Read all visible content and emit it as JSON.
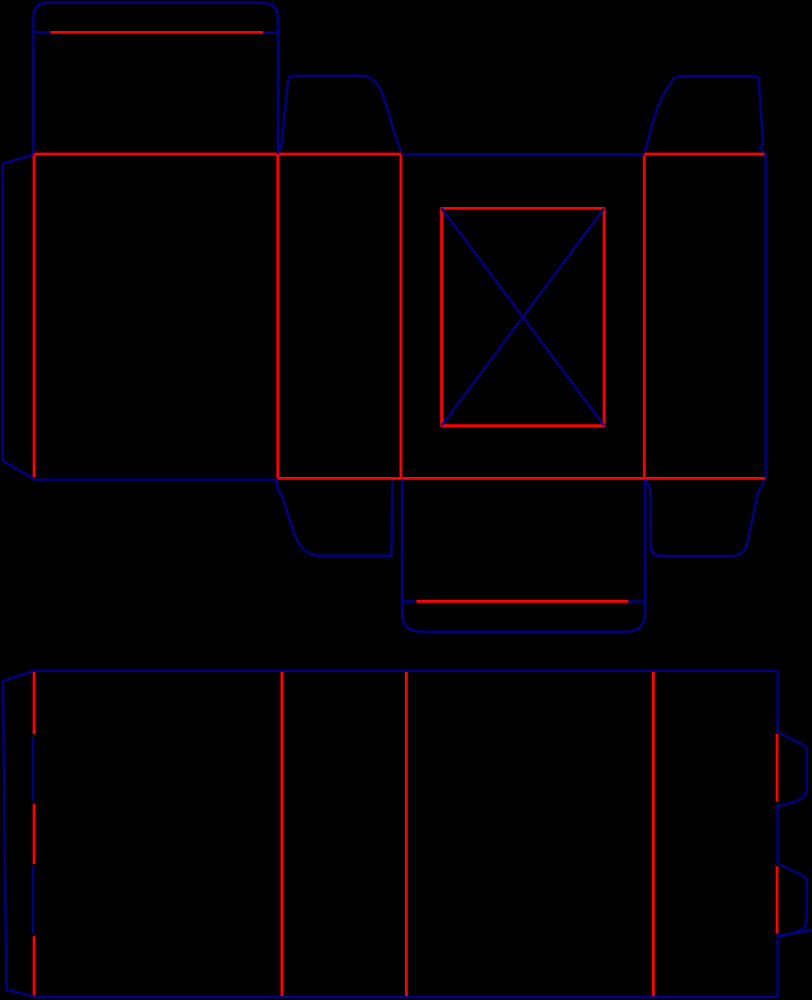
{
  "canvas": {
    "width": 812,
    "height": 1000,
    "background": "#000000"
  },
  "styles": {
    "cut": {
      "color": "#00008b",
      "width": 2.3
    },
    "crease": {
      "color": "#ff0000",
      "width": 2.8
    }
  },
  "diagram": {
    "type": "packaging-dieline",
    "pieces": [
      {
        "name": "upper-carton-blank",
        "creases": [
          {
            "name": "lid-lip-crease",
            "d": "M 50.2 32.4 L 263.2 32.4"
          },
          {
            "name": "band-top-crease-left",
            "d": "M 33.4 154 L 400.9 154"
          },
          {
            "name": "band-top-crease-right",
            "d": "M 644.3 154 L 765.6 154"
          },
          {
            "name": "band-bottom-crease",
            "d": "M 277.8 478.4 L 765.6 478.4"
          },
          {
            "name": "glue-flap-crease",
            "d": "M 34 154 L 34 477.6"
          },
          {
            "name": "panel1-panel2-crease",
            "d": "M 277.8 154 L 277.8 478.4"
          },
          {
            "name": "panel2-panel3-crease",
            "d": "M 400.9 154 L 400.9 478.4"
          },
          {
            "name": "panel3-panel4-crease",
            "d": "M 644.3 154 L 644.3 478.4"
          },
          {
            "name": "tuck-lip-crease",
            "d": "M 416.3 601.4 L 628.4 601.4"
          },
          {
            "name": "window-frame",
            "d": "M 441.6 208.4 L 604.1 208.4 L 604.1 425.6 L 441.6 425.6 Z"
          }
        ],
        "cuts": [
          {
            "name": "lid-flap-outline",
            "d": "M 33.4 154 L 33.4 18 Q 33.4 2.6 49 2.6 L 262 2.6 Q 277.8 2.6 277.8 18 L 277.8 154"
          },
          {
            "name": "lid-lip-cut-tick-left",
            "d": "M 33.4 32.4 L 50.2 32.4"
          },
          {
            "name": "lid-lip-cut-tick-right",
            "d": "M 263.2 32.4 L 277.8 32.4"
          },
          {
            "name": "glue-flap-outline",
            "d": "M 33.4 154.6 L 2.9 163.6 L 2.4 460.6 L 33.4 478.4"
          },
          {
            "name": "panel1-bottom-cut",
            "d": "M 33.4 479.6 L 277.2 479.6"
          },
          {
            "name": "top-dust-flap-left",
            "d": "M 278.4 151.6 L 281.4 146 L 288.3 79 Q 288.9 75.6 293.1 75.6 L 362 75.6 C 374 76.6 380.2 86.2 384.7 100.2 L 391.7 124 Q 395.2 136.2 397.5 142.2 L 399.2 147.4 L 400.9 152"
          },
          {
            "name": "top-dust-flap-right",
            "d": "M 644.4 152 L 646.4 146.6 L 649.6 134.6 C 654.1 114.2 661.2 96.2 669.7 84.7 Q 673.7 75.9 681.7 75.9 L 753.6 75.9 Q 758.4 75.9 758.7 80.6 L 763 143.6 L 759.7 148.7 L 765.5 153"
          },
          {
            "name": "panel3-top-cut",
            "d": "M 400.9 154.3 L 644.3 154.3"
          },
          {
            "name": "band-right-edge-cut",
            "d": "M 765.6 153.2 L 765.6 477.4"
          },
          {
            "name": "bottom-dust-flap-left",
            "d": "M 277 479.8 L 277.8 490.6 L 282 495.6 L 291.6 526.2 C 296.1 540.7 301.1 549.2 309.1 553.2 Q 313.6 555.7 321.1 555.7 L 391.4 555.7 L 392.3 480.6"
          },
          {
            "name": "bottom-dust-flap-right",
            "d": "M 646 480.2 L 647.8 484.2 L 650.1 487.7 L 650.9 546.2 Q 651.1 555.9 660.6 555.9 L 731.1 555.9 Q 743.6 555.9 747.1 544.2 L 756.6 498.7 L 758.2 491.2 L 761.7 486.4 L 764.2 480.2"
          },
          {
            "name": "tuck-flap-outline",
            "d": "M 401.9 479.2 L 401.9 612.6 Q 401.9 631.7 421.6 631.7 L 625.9 631.7 Q 645.2 631.7 645.2 612.6 L 645.2 479.2"
          },
          {
            "name": "tuck-lip-cut-tick-left",
            "d": "M 401.9 601.4 L 416.3 601.4"
          },
          {
            "name": "tuck-lip-cut-tick-right",
            "d": "M 628.4 601.4 L 645.2 601.4"
          },
          {
            "name": "window-diagonal-nw-se",
            "d": "M 441.6 208.4 L 604.1 425.6"
          },
          {
            "name": "window-diagonal-ne-sw",
            "d": "M 604.1 208.4 L 441.6 425.6"
          }
        ]
      },
      {
        "name": "lower-sleeve-blank",
        "creases": [
          {
            "name": "zipper-crease-top",
            "d": "M 34 671 L 34 734.2"
          },
          {
            "name": "zipper-crease-middle",
            "d": "M 34 803.6 L 34 864.2"
          },
          {
            "name": "zipper-crease-bottom",
            "d": "M 34 936.2 L 34 995.6"
          },
          {
            "name": "panelA-panelB-crease",
            "d": "M 281.9 671 L 281.9 997"
          },
          {
            "name": "panelB-panelC-crease",
            "d": "M 406.4 671 L 406.4 997"
          },
          {
            "name": "panelC-panelD-crease",
            "d": "M 653.4 671 L 653.4 997"
          },
          {
            "name": "tab1-fold-crease",
            "d": "M 777 733.6 L 777 801.6"
          },
          {
            "name": "tab2-fold-crease",
            "d": "M 777 866.2 L 777 933.6"
          }
        ],
        "cuts": [
          {
            "name": "top-edge-cut",
            "d": "M 33.4 670.9 L 777 670.9"
          },
          {
            "name": "left-top-slant-cut",
            "d": "M 33.4 670.9 L 2.9 681.1"
          },
          {
            "name": "left-edge-cut",
            "d": "M 2.9 681.1 L 6.3 989.6"
          },
          {
            "name": "left-bottom-slant-cut",
            "d": "M 6.3 989.6 L 33.4 996.3"
          },
          {
            "name": "bottom-edge-cut",
            "d": "M 33.4 997.1 L 777.5 997.1"
          },
          {
            "name": "right-edge-cut-upper",
            "d": "M 777.5 670.9 L 777.5 732.1"
          },
          {
            "name": "tab1-outline",
            "d": "M 777.5 732.1 L 802.6 744.6 Q 806.7 746.6 806.7 751.1 L 806.7 788.1 Q 806.7 794.6 801.6 798.1 Q 796.6 801.6 789.6 803.1 L 777.5 805.9"
          },
          {
            "name": "right-edge-cut-middle",
            "d": "M 777.5 805.9 L 777.5 863.1"
          },
          {
            "name": "tab2-outline",
            "d": "M 777.5 863.1 L 802.6 875.6 Q 806.7 877.6 806.7 882.1 L 806.7 919.1 Q 806.7 925.6 801.6 929.1 Q 796.6 932.6 789.6 934.1 L 777.5 936.6"
          },
          {
            "name": "right-edge-cut-lower",
            "d": "M 777.5 936.6 L 777.5 997.1"
          },
          {
            "name": "tab3-clipped-cut",
            "d": "M 777.5 935.6 L 812 930.2"
          },
          {
            "name": "zipper-cut-upper",
            "d": "M 33 737 L 33 801"
          },
          {
            "name": "zipper-cut-lower",
            "d": "M 33 866 L 33 933"
          }
        ]
      }
    ]
  }
}
